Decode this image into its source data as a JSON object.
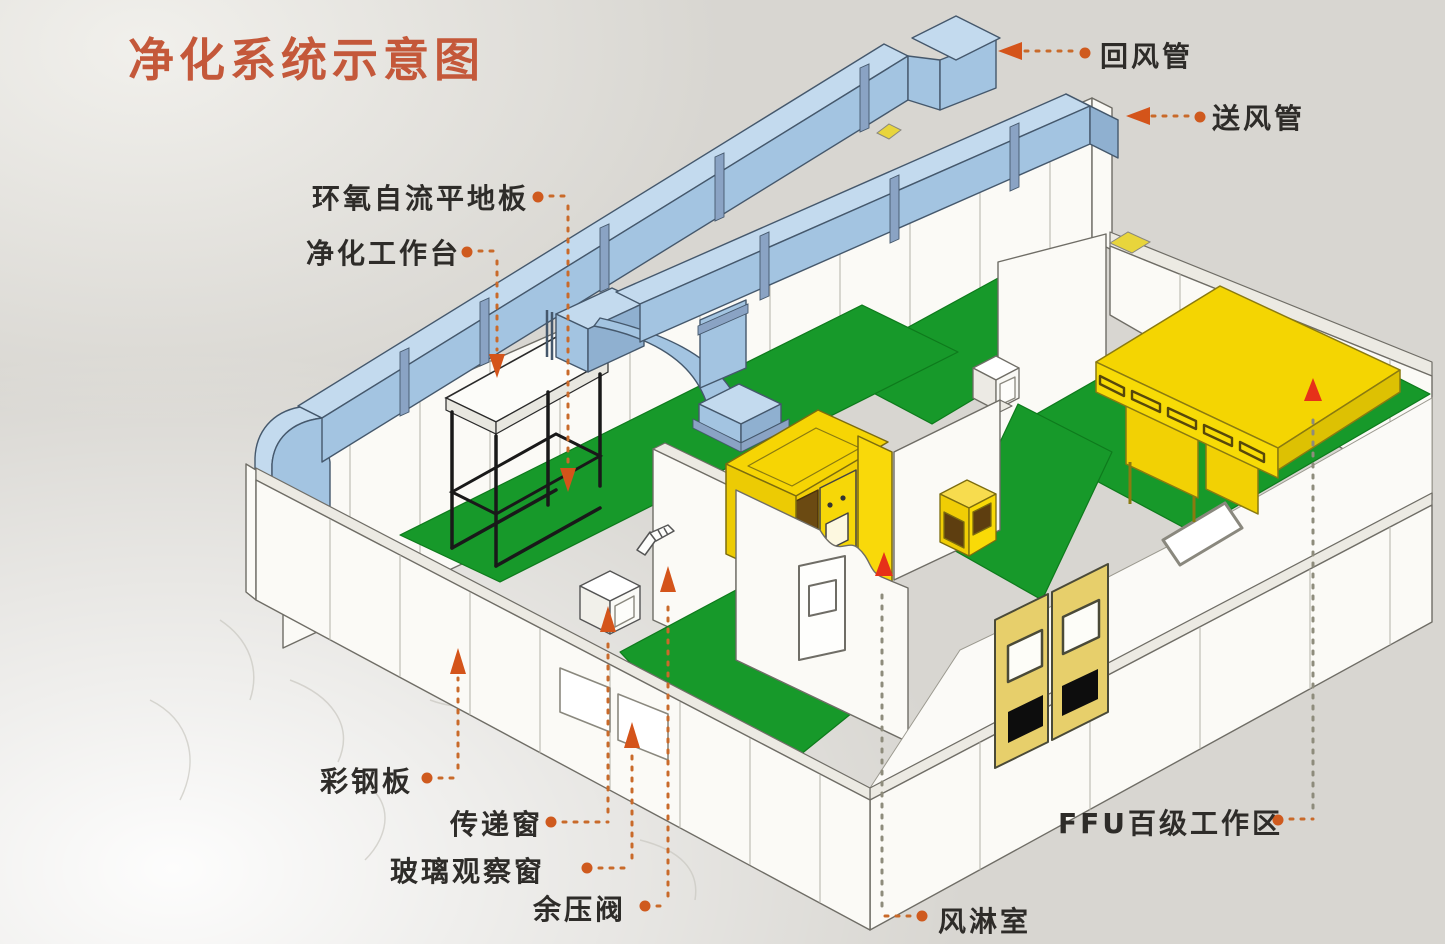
{
  "title": "净化系统示意图",
  "legend_labels": {
    "return_duct": "回风管",
    "supply_duct": "送风管",
    "epoxy_self_leveling_floor": "环氧自流平地板",
    "clean_workbench": "净化工作台",
    "color_steel_panel": "彩钢板",
    "transfer_window": "传递窗",
    "glass_observation_window": "玻璃观察窗",
    "residual_pressure_valve": "余压阀",
    "air_shower_room": "风淋室",
    "ffu_class100_work_area": "FFU百级工作区"
  },
  "colors": {
    "title_text": "#c4583a",
    "label_text": "#2e2c29",
    "leader_accent": "#cf5a1e",
    "red_arrow": "#e63119",
    "duct_blue": "#a3c4e1",
    "floor_green": "#17992a",
    "highlight_yellow": "#f5d403",
    "door_yellow": "#e7cf6b",
    "wall_white": "#fbfaf6",
    "background": "#d8d6d1"
  }
}
